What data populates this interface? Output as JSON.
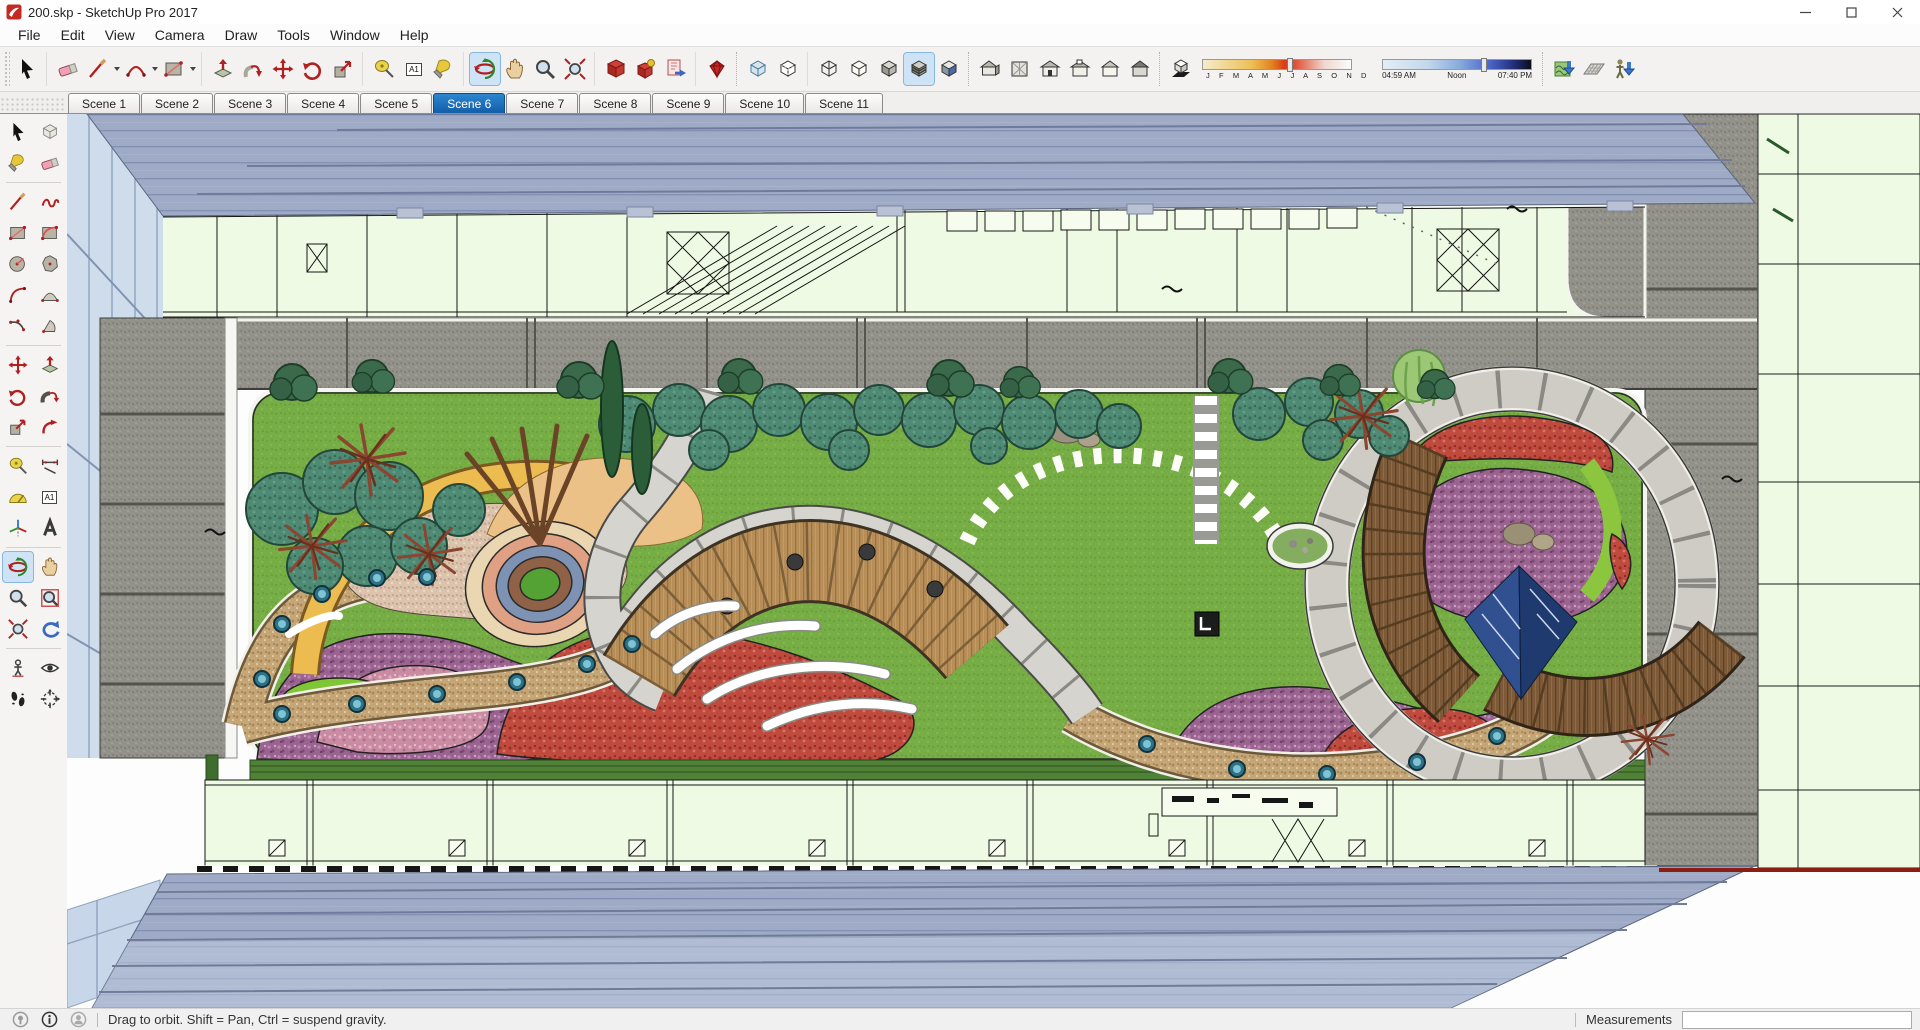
{
  "window": {
    "title": "200.skp - SketchUp Pro 2017"
  },
  "menu": {
    "items": [
      "File",
      "Edit",
      "View",
      "Camera",
      "Draw",
      "Tools",
      "Window",
      "Help"
    ]
  },
  "toolbar": {
    "text_tool_label": "A1",
    "shadows": {
      "months": "J F M A M J J A S O N D",
      "sunrise": "04:59 AM",
      "noon": "Noon",
      "sunset": "07:40 PM"
    },
    "icon_names": [
      "select",
      "eraser",
      "line",
      "arc",
      "rectangle",
      "push-pull",
      "follow-me",
      "move",
      "rotate",
      "scale",
      "tape-measure",
      "text",
      "paint-bucket",
      "orbit",
      "pan",
      "zoom",
      "zoom-extents",
      "component",
      "warehouse",
      "send-to-layout",
      "extension-warehouse",
      "xray",
      "back-edges",
      "wireframe",
      "hidden-line",
      "shaded",
      "shaded-with-textures",
      "monochrome",
      "view-iso",
      "view-top",
      "view-front",
      "view-back",
      "view-left",
      "view-right",
      "shadow-toggle",
      "date-slider",
      "time-slider",
      "from-contours",
      "from-scratch",
      "drop"
    ]
  },
  "scenes": {
    "tabs": [
      "Scene 1",
      "Scene 2",
      "Scene 3",
      "Scene 4",
      "Scene 5",
      "Scene 6",
      "Scene 7",
      "Scene 8",
      "Scene 9",
      "Scene 10",
      "Scene 11"
    ],
    "active": "Scene 6"
  },
  "left_toolbar": {
    "tools": [
      "select",
      "make-component",
      "paint-bucket",
      "eraser",
      "line",
      "freehand",
      "rectangle",
      "rotated-rectangle",
      "circle",
      "polygon",
      "arc",
      "two-point-arc",
      "three-point-arc",
      "pie",
      "move",
      "push-pull",
      "rotate",
      "follow-me",
      "scale",
      "offset",
      "tape-measure",
      "dimension",
      "protractor",
      "text",
      "axes",
      "3d-text",
      "orbit",
      "pan",
      "zoom",
      "zoom-window",
      "zoom-extents",
      "previous",
      "position-camera",
      "look-around",
      "walk",
      "section-plane"
    ],
    "active_tool": "orbit"
  },
  "statusbar": {
    "hint": "Drag to orbit. Shift = Pan, Ctrl = suspend gravity.",
    "measurements_label": "Measurements",
    "measurements_value": ""
  },
  "colors": {
    "active_tab_blue": "#1b6ab5",
    "tool_highlight": "#cfe3f6",
    "lawn_green": "#76ae45",
    "roof_blue": "#9fabc6",
    "granite_gray": "#90908a",
    "mint_floor": "#eefae3",
    "accent_red": "#b02020"
  }
}
